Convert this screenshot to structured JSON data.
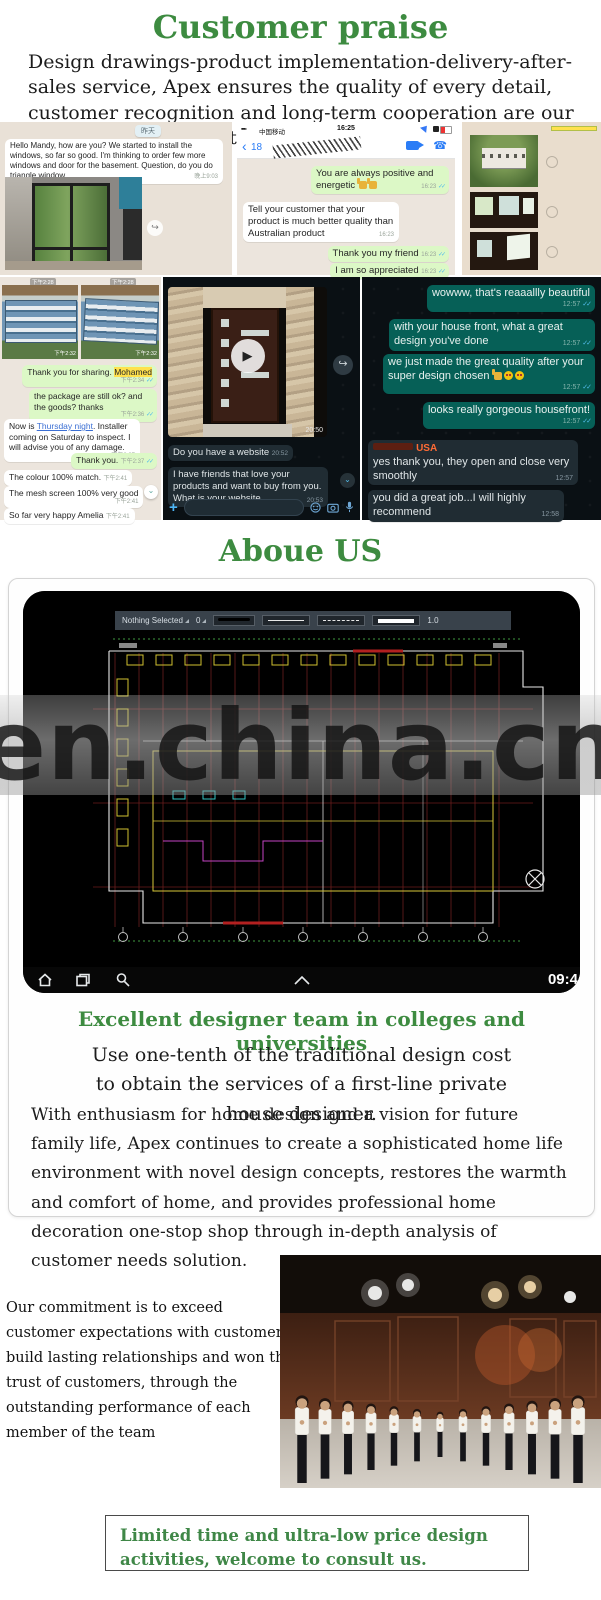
{
  "colors": {
    "green_heading": "#3d8b40",
    "bubble_out": "#dcf8c6",
    "bubble_teal": "#066057",
    "dark_bg": "#0a1014",
    "sender_orange": "#ff6b35",
    "highlight_yellow": "#ffe14d"
  },
  "glyphs": {
    "play": "▶",
    "forward": "↪",
    "chevron_down": "⌄",
    "plus": "+",
    "back": "‹",
    "double_check": "✓✓",
    "phone": "☎"
  },
  "header": {
    "title": "Customer praise",
    "intro": "Design drawings-product implementation-delivery-after-sales service, Apex ensures the quality of every detail, customer recognition and long-term cooperation are our greatest achievements."
  },
  "row1": {
    "panel_a": {
      "date_badge": "昨天",
      "incoming_text": "Hello Mandy, how are you? We started to install the windows, so far so good. I'm thinking to order few more windows and door for the basement. Question, do you do triangle window",
      "incoming_time": "晚上9:03"
    },
    "panel_b": {
      "carrier": "中国移动",
      "status_time": "16:25",
      "back_count": "18",
      "m1": {
        "text": "You are always positive and energetic",
        "time": "16:23"
      },
      "m2": {
        "text": "Tell your customer that your product is much better quality than Australian product",
        "time": "16:23"
      },
      "m3": {
        "text": "Thank you my friend",
        "time": "16:23"
      },
      "m4": {
        "text": "I am so appreciated",
        "time": "16:23"
      }
    }
  },
  "row2": {
    "panel_d": {
      "top_time_1": "下午2:28",
      "top_time_2": "下午2:28",
      "photo_time_1": "下午2:32",
      "photo_time_2": "下午2:32",
      "m1_pre": "Thank you for sharing. ",
      "m1_hl": "Mohamed",
      "m1_time": "下午2:34",
      "m2": "the package are still ok? and the goods? thanks",
      "m2_time": "下午2:36",
      "m3_pre": "Now is ",
      "m3_link": "Thursday night",
      "m3_post": ". Installer coming on Saturday to inspect. I will advise you of any damage.",
      "m3_time": "下午2:37",
      "m4": "Thank you.",
      "m4_time": "下午2:37",
      "m5": "The colour 100% match.",
      "m5_time": "下午2:41",
      "m6": "The mesh screen 100% very good",
      "m6_time": "下午2:41",
      "m7": "So far very happy Amelia",
      "m7_time": "下午2:41"
    },
    "panel_e": {
      "video_time": "20:50",
      "m1": "Do you have a website",
      "m1_time": "20:52",
      "m2": "I have friends that love your products and want to buy from you. What is your website",
      "m2_time": "20:53"
    },
    "panel_f": {
      "m1": "wowww, that's reaaallly beautiful",
      "m1_time": "12:57",
      "m2": "with your house front, what a great design you've done",
      "m2_time": "12:57",
      "m3": "we just made the great quality after your super design chosen",
      "m3_time": "12:57",
      "m4": "looks really gorgeous housefront!",
      "m4_time": "12:57",
      "sender": "USA",
      "m5": "yes thank you, they open and close very smoothly",
      "m5_time": "12:57",
      "m6": "you did a great job...I will highly recommend",
      "m6_time": "12:58"
    }
  },
  "about": {
    "title": "Aboue US",
    "cad": {
      "toolbar_selected": "Nothing Selected",
      "toolbar_layer": "0",
      "toolbar_zoom": "1.0",
      "nav_time": "09:4",
      "watermark": "en.china.cn"
    },
    "subtitle": "Excellent designer team in colleges and universities",
    "lead": "Use one-tenth of the traditional design cost to obtain the services of a first-line private house designer.",
    "body": "With enthusiasm for home design and a vision for future family life, Apex continues to create a sophisticated home life environment with novel design concepts, restores the warmth and comfort of home, and provides professional home decoration one-stop shop through in-depth analysis of customer needs solution."
  },
  "commitment": {
    "text": "Our commitment is to exceed customer expectations with customers build lasting relationships and  won the trust  of  customers, through the outstanding performance of each member of the team"
  },
  "footer": {
    "box_text": "Limited time and ultra-low price design activities, welcome to consult us."
  }
}
